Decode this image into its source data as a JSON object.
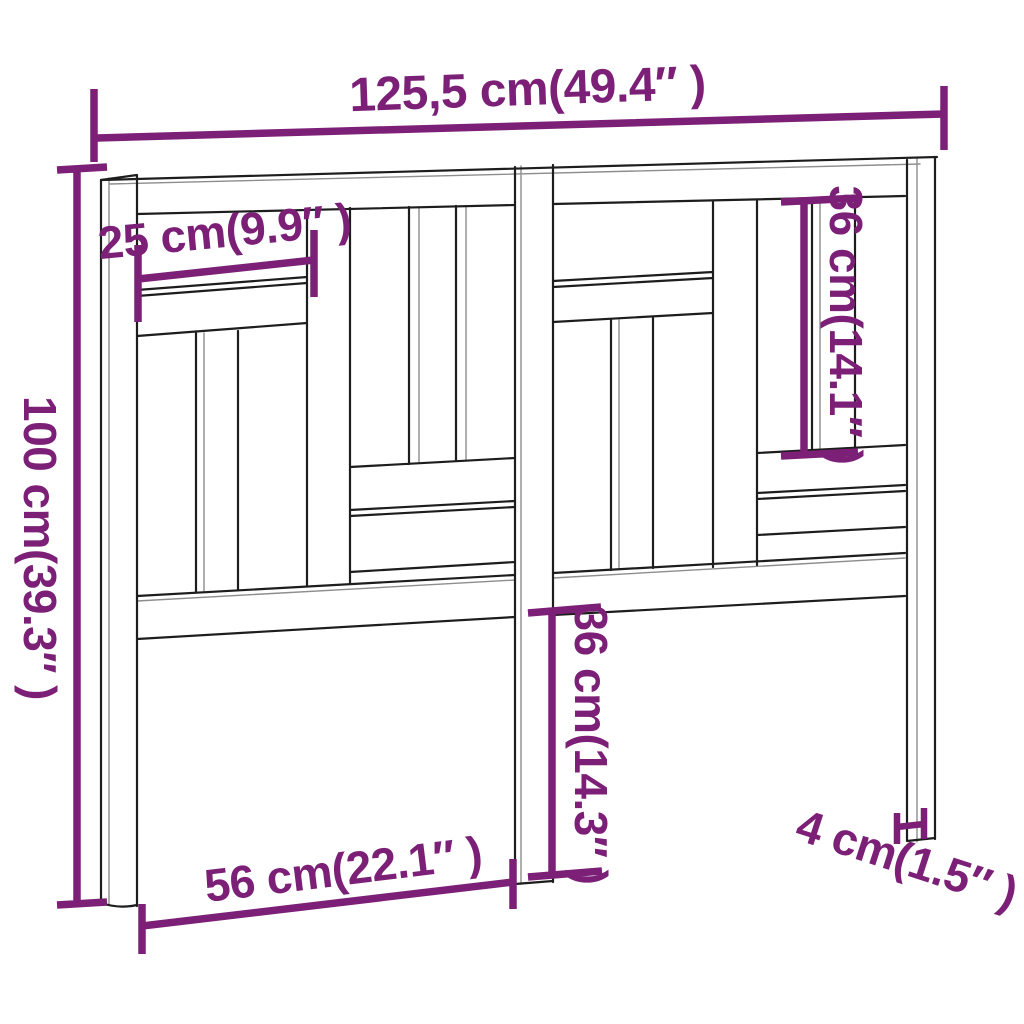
{
  "diagram": {
    "product": "headboard-dimension-drawing",
    "measurements": [
      {
        "id": "total_width",
        "label": "125,5 cm(49.4″ )",
        "cm": "125,5",
        "inches": "49.4"
      },
      {
        "id": "total_height",
        "label": "100 cm(39.3″ )",
        "cm": "100",
        "inches": "39.3"
      },
      {
        "id": "top_board_length",
        "label": "25 cm(9.9″ )",
        "cm": "25",
        "inches": "9.9"
      },
      {
        "id": "upper_panel_height",
        "label": "36 cm(14.1″ )",
        "cm": "36",
        "inches": "14.1"
      },
      {
        "id": "leg_height",
        "label": "36 cm(14.3″ )",
        "cm": "36",
        "inches": "14.3"
      },
      {
        "id": "leg_spacing",
        "label": "56 cm(22.1″ )",
        "cm": "56",
        "inches": "22.1"
      },
      {
        "id": "leg_thickness",
        "label": "4 cm(1.5″ )",
        "cm": "4",
        "inches": "1.5"
      }
    ]
  },
  "colors": {
    "dimension": "#7C2077",
    "outline": "#1D1D1D",
    "outline_soft": "#8D8D8D",
    "background": "#FFFFFF"
  }
}
